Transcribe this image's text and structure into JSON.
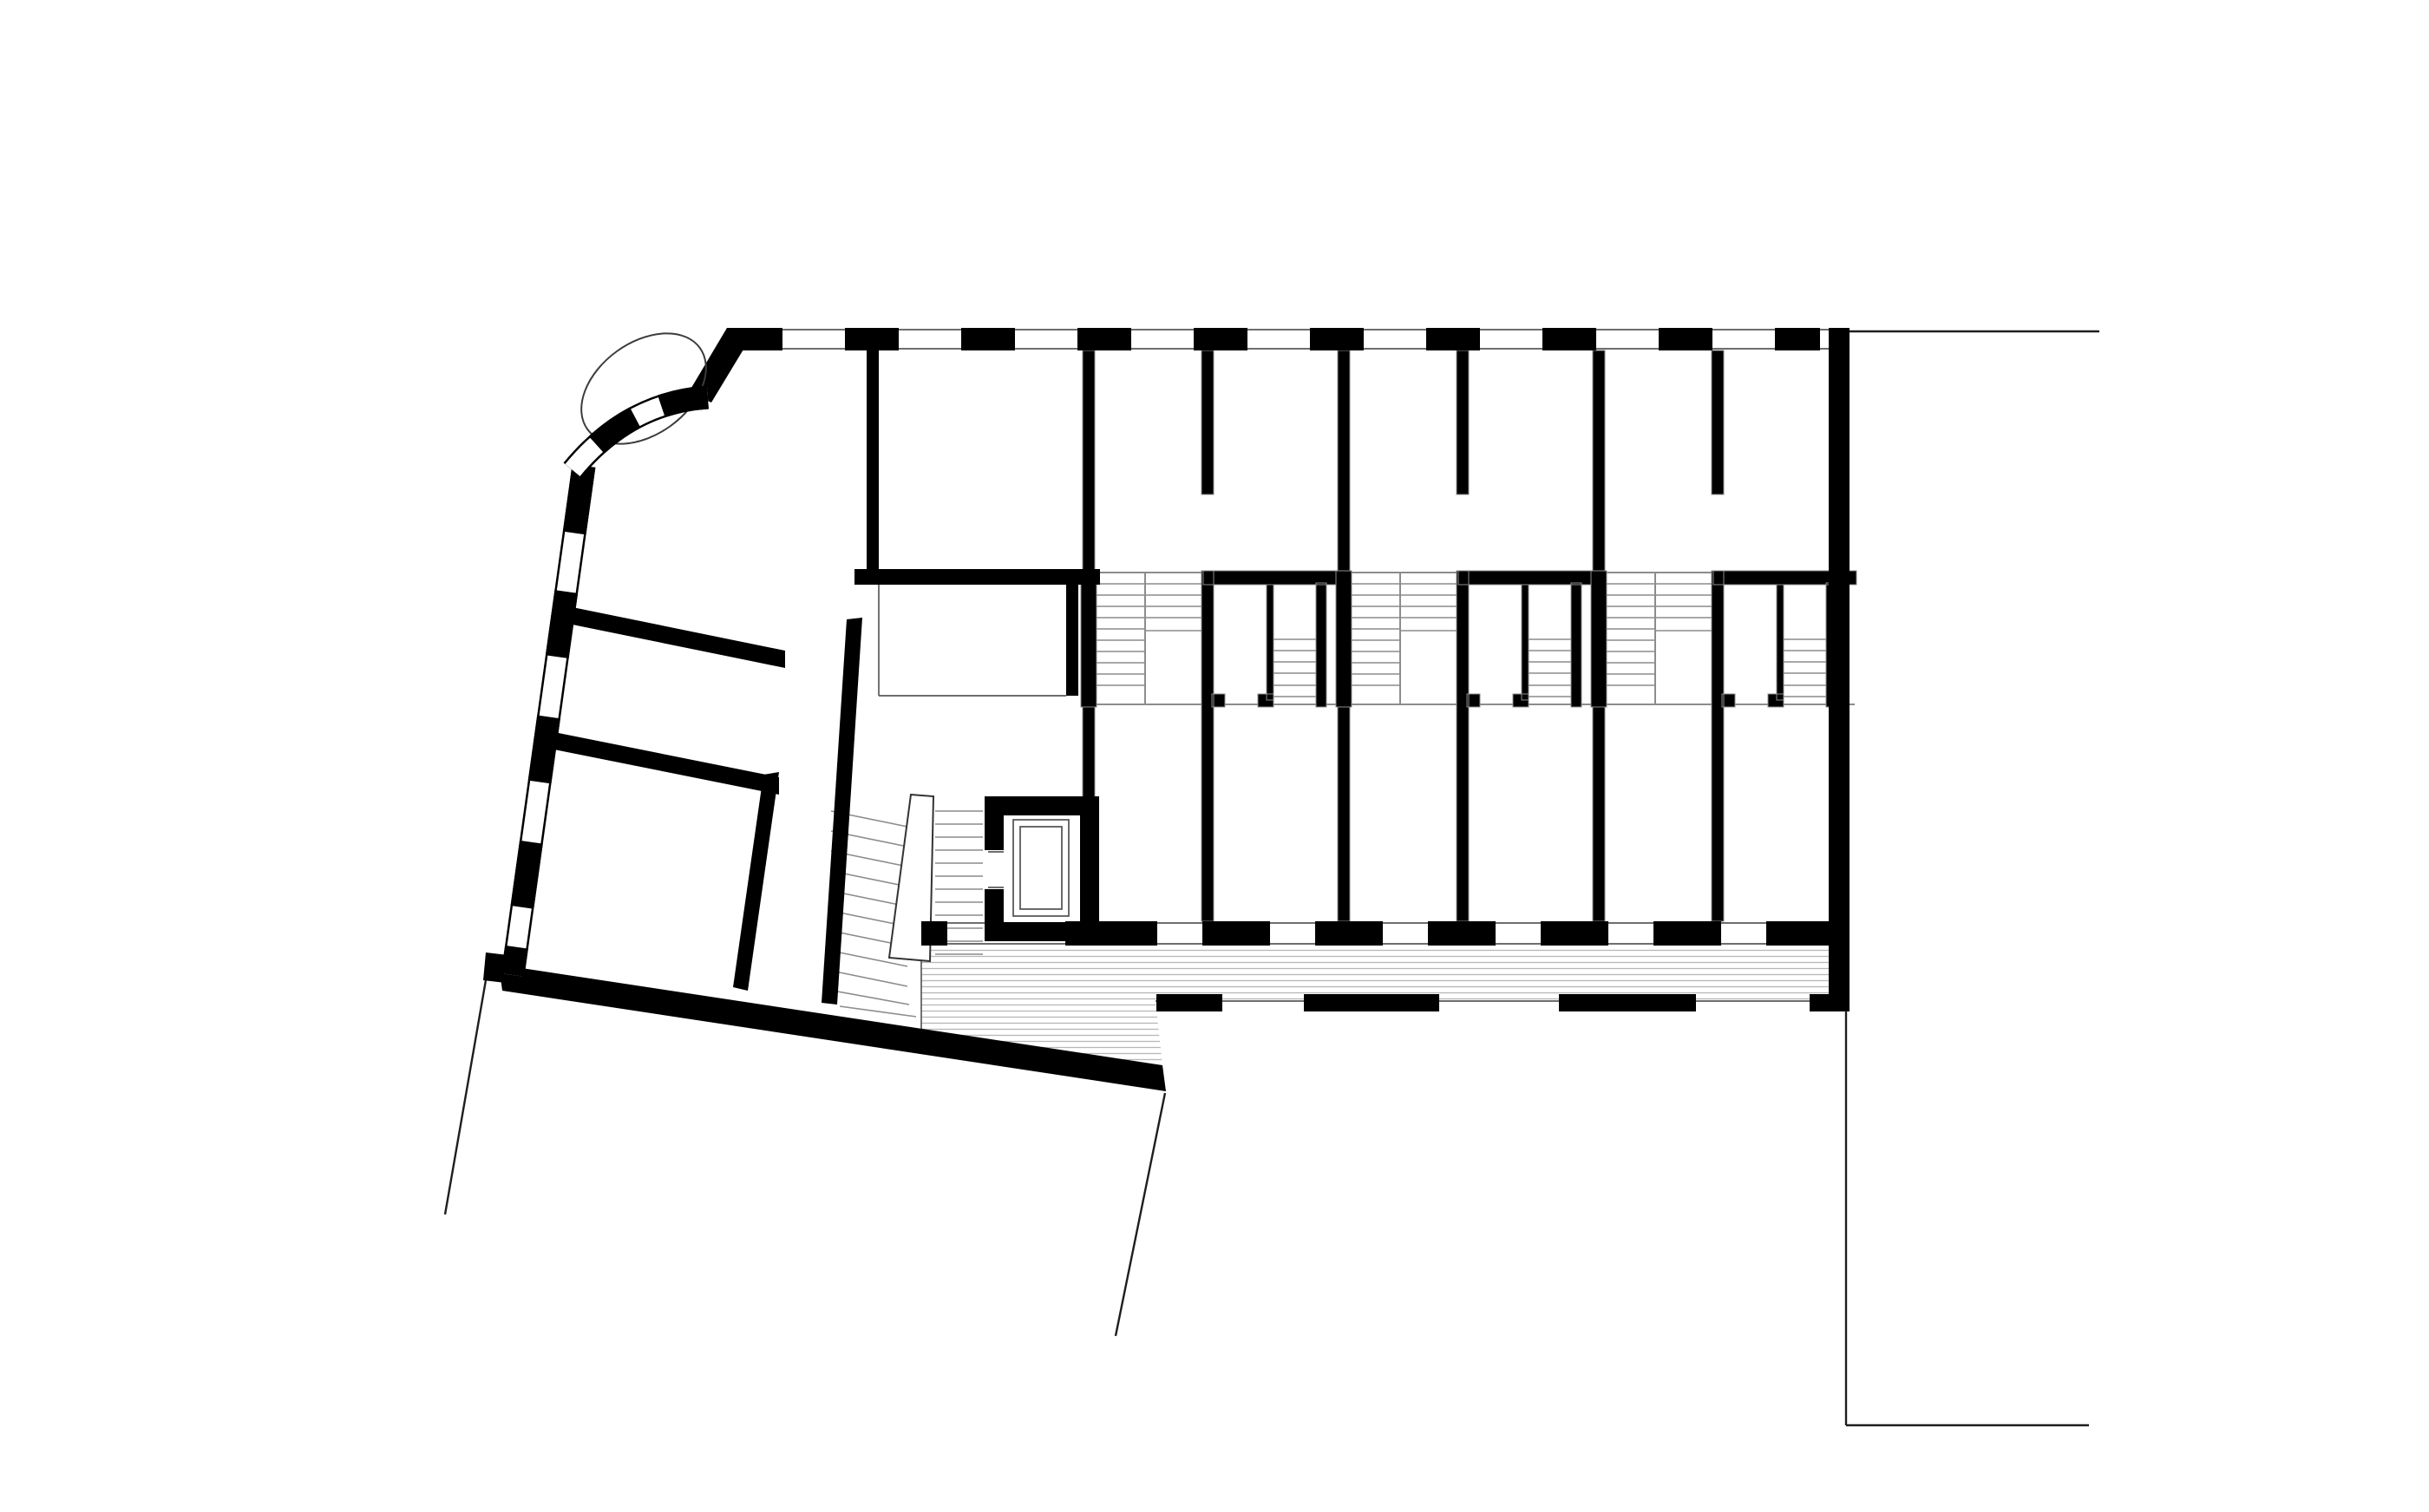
{
  "title": "Floor plan",
  "plan": {
    "type": "architectural-floor-plan",
    "style": "black and white line drawing, no text labels",
    "colors": {
      "background": "#ffffff",
      "wall": "#000000",
      "tread": "#8c8c8c",
      "thin": "#3c3c3c",
      "hatch": "#b8b8b8",
      "glazing": "#5a5a5a",
      "property_line": "#1e1e1e",
      "outline": "#333333"
    },
    "elements": {
      "row_house_units": 3,
      "unit_stair_flights": 3,
      "central_stair_hall": 1,
      "elevator_shaft": 1,
      "curved_bay_window": 1,
      "balcony_strip_hatched": 1,
      "facade_window_bands": 3,
      "property_boundary_lines": 5
    }
  }
}
